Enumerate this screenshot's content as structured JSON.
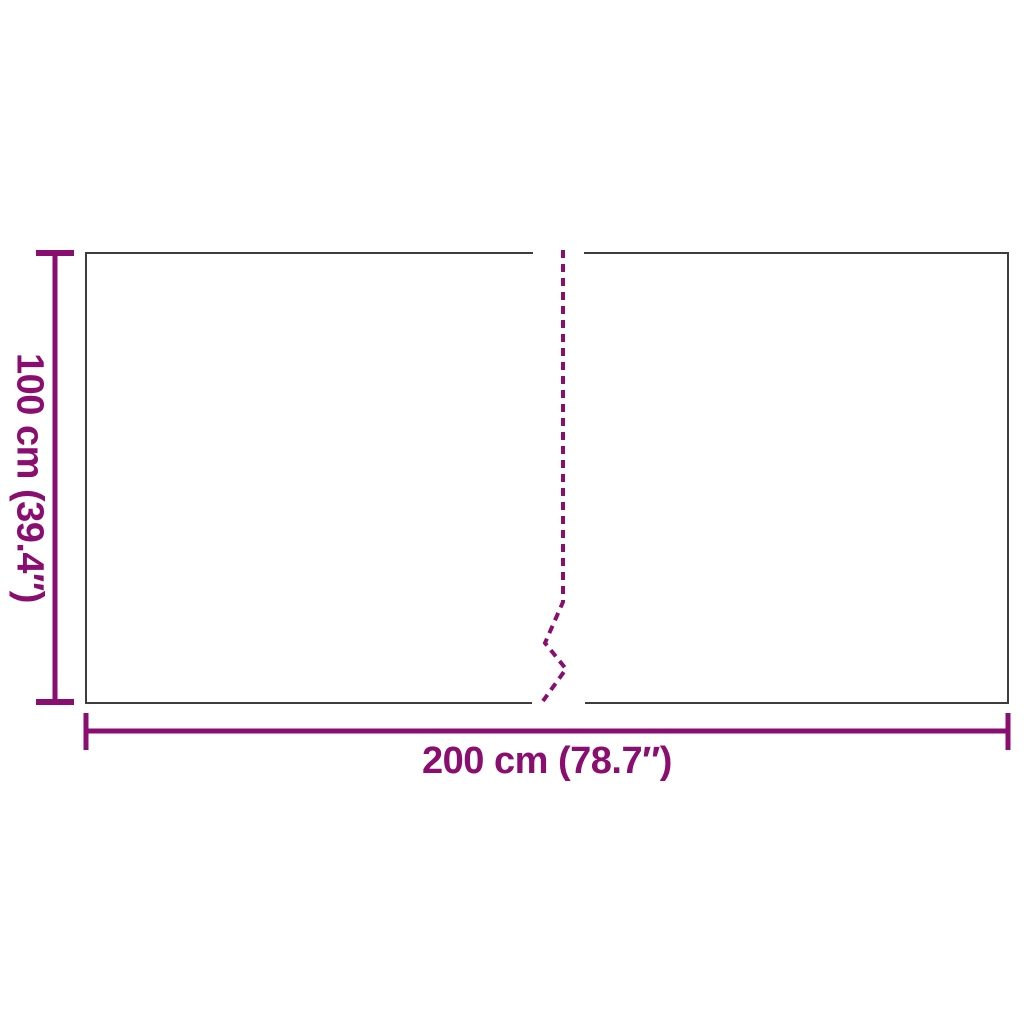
{
  "diagram": {
    "kind": "product-dimension-diagram",
    "shape": "rectangle-with-center-fold-line"
  },
  "colors": {
    "accent": "#8A0E70",
    "outline": "#3d3d3d",
    "background": "#ffffff"
  },
  "product": {
    "width_label": "200 cm (78.7″)",
    "height_label": "100 cm (39.4″)",
    "width_value_cm": 200,
    "width_value_in": 78.7,
    "height_value_cm": 100,
    "height_value_in": 39.4
  }
}
